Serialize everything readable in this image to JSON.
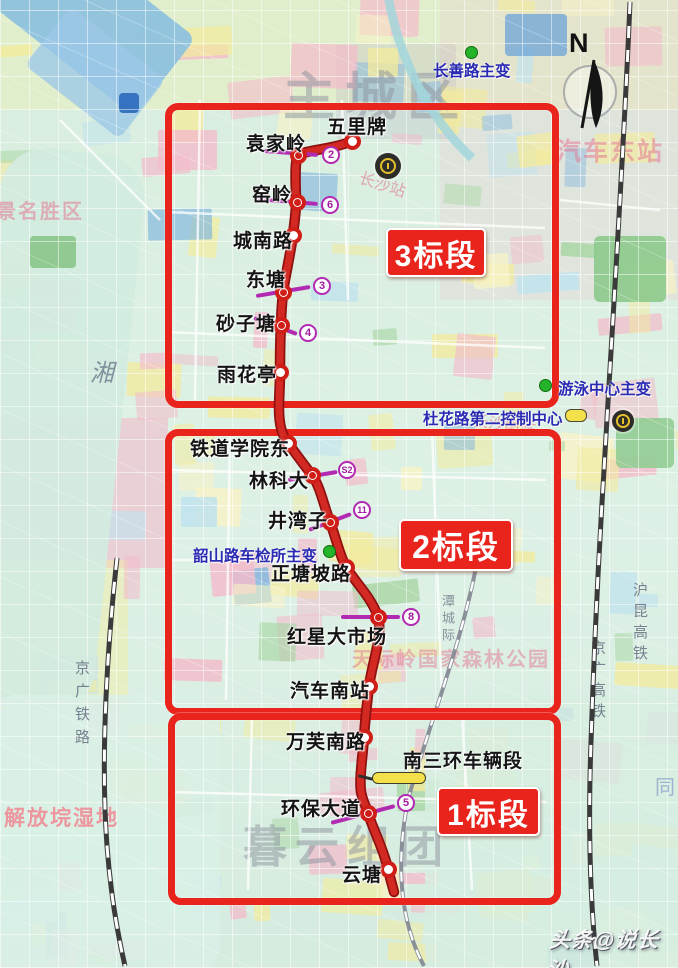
{
  "colors": {
    "metro_line": "#d22a22",
    "metro_line_edge": "#8f1010",
    "section_red": "#e8241c",
    "badge_purple": "#b12ab1",
    "facility_blue": "#2a2ab2",
    "green_dot": "#25b32a",
    "depot_yellow": "#f3e04b"
  },
  "compass": {
    "label": "N"
  },
  "credit": {
    "text": "头条@说长沙"
  },
  "sections": [
    {
      "id": "3",
      "label": "3标段",
      "box": {
        "x": 165,
        "y": 103,
        "w": 380,
        "h": 291
      },
      "tag": {
        "x": 386,
        "y": 228,
        "w": 96,
        "h": 45,
        "font": 30
      }
    },
    {
      "id": "2",
      "label": "2标段",
      "box": {
        "x": 165,
        "y": 429,
        "w": 382,
        "h": 272
      },
      "tag": {
        "x": 399,
        "y": 519,
        "w": 110,
        "h": 48,
        "font": 32
      }
    },
    {
      "id": "1",
      "label": "1标段",
      "box": {
        "x": 168,
        "y": 713,
        "w": 379,
        "h": 178
      },
      "tag": {
        "x": 437,
        "y": 787,
        "w": 99,
        "h": 45,
        "font": 30
      }
    }
  ],
  "stations": [
    {
      "name": "五里牌",
      "x": 352,
      "y": 141,
      "transfer": false,
      "label": {
        "x": 327,
        "y": 112
      }
    },
    {
      "name": "袁家岭",
      "x": 298,
      "y": 155,
      "transfer": true,
      "label": {
        "x": 246,
        "y": 129
      },
      "badge": {
        "text": "2",
        "x": 331,
        "y": 155
      },
      "tick": {
        "x1": 264,
        "y1": 151,
        "x2": 318,
        "y2": 155
      }
    },
    {
      "name": "窑岭",
      "x": 297,
      "y": 202,
      "transfer": true,
      "label": {
        "x": 252,
        "y": 180
      },
      "badge": {
        "text": "6",
        "x": 330,
        "y": 205
      },
      "tick": {
        "x1": 256,
        "y1": 199,
        "x2": 318,
        "y2": 204
      }
    },
    {
      "name": "城南路",
      "x": 293,
      "y": 235,
      "transfer": false,
      "label": {
        "x": 233,
        "y": 226
      }
    },
    {
      "name": "东塘",
      "x": 283,
      "y": 292,
      "transfer": true,
      "label": {
        "x": 246,
        "y": 265
      },
      "badge": {
        "text": "3",
        "x": 322,
        "y": 286
      },
      "tick": {
        "x1": 256,
        "y1": 296,
        "x2": 310,
        "y2": 287
      }
    },
    {
      "name": "砂子塘",
      "x": 281,
      "y": 325,
      "transfer": true,
      "label": {
        "x": 216,
        "y": 309
      },
      "badge": {
        "text": "4",
        "x": 308,
        "y": 333
      },
      "tick": {
        "x1": 254,
        "y1": 318,
        "x2": 297,
        "y2": 334
      }
    },
    {
      "name": "雨花亭",
      "x": 280,
      "y": 372,
      "transfer": false,
      "label": {
        "x": 217,
        "y": 360
      }
    },
    {
      "name": "铁道学院东",
      "x": 288,
      "y": 443,
      "transfer": false,
      "label": {
        "x": 190,
        "y": 434
      }
    },
    {
      "name": "林科大",
      "x": 312,
      "y": 475,
      "transfer": true,
      "label": {
        "x": 249,
        "y": 466
      },
      "badge": {
        "text": "S2",
        "x": 347,
        "y": 470
      },
      "tick": {
        "x1": 288,
        "y1": 480,
        "x2": 337,
        "y2": 472
      }
    },
    {
      "name": "井湾子",
      "x": 330,
      "y": 522,
      "transfer": true,
      "label": {
        "x": 268,
        "y": 506
      },
      "badge": {
        "text": "11",
        "x": 362,
        "y": 510
      },
      "tick": {
        "x1": 309,
        "y1": 530,
        "x2": 351,
        "y2": 514
      }
    },
    {
      "name": "正塘坡路",
      "x": 346,
      "y": 567,
      "transfer": false,
      "label": {
        "x": 271,
        "y": 559
      }
    },
    {
      "name": "红星大市场",
      "x": 378,
      "y": 617,
      "transfer": true,
      "label": {
        "x": 287,
        "y": 622
      },
      "badge": {
        "text": "8",
        "x": 411,
        "y": 617
      },
      "tick": {
        "x1": 341,
        "y1": 617,
        "x2": 400,
        "y2": 617
      }
    },
    {
      "name": "汽车南站",
      "x": 369,
      "y": 686,
      "transfer": false,
      "label": {
        "x": 290,
        "y": 676
      }
    },
    {
      "name": "万芙南路",
      "x": 364,
      "y": 737,
      "transfer": false,
      "label": {
        "x": 286,
        "y": 727
      }
    },
    {
      "name": "环保大道",
      "x": 368,
      "y": 813,
      "transfer": true,
      "label": {
        "x": 281,
        "y": 794
      },
      "badge": {
        "text": "5",
        "x": 406,
        "y": 803
      },
      "tick": {
        "x1": 331,
        "y1": 823,
        "x2": 395,
        "y2": 806
      }
    },
    {
      "name": "云塘",
      "x": 388,
      "y": 869,
      "transfer": false,
      "label": {
        "x": 342,
        "y": 860
      }
    }
  ],
  "facilities": [
    {
      "type": "substation",
      "label": "长善路主变",
      "dot": {
        "x": 471,
        "y": 52
      },
      "label_pos": {
        "x": 433,
        "y": 59
      }
    },
    {
      "type": "substation",
      "label": "游泳中心主变",
      "dot": {
        "x": 545,
        "y": 385
      },
      "label_pos": {
        "x": 558,
        "y": 377
      }
    },
    {
      "type": "control_center",
      "label": "杜花路第二控制中心",
      "symbol": {
        "x": 565,
        "y": 409
      },
      "label_pos": {
        "x": 423,
        "y": 407
      }
    },
    {
      "type": "substation",
      "label": "韶山路车检所主变",
      "dot": {
        "x": 329,
        "y": 551
      },
      "label_pos": {
        "x": 193,
        "y": 544
      }
    },
    {
      "type": "depot",
      "label": "南三环车辆段",
      "symbol": {
        "x": 372,
        "y": 772
      },
      "label_pos": {
        "x": 403,
        "y": 746
      }
    }
  ],
  "rail_icons": [
    {
      "x": 388,
      "y": 166,
      "size": 26
    },
    {
      "x": 623,
      "y": 421,
      "size": 22
    }
  ],
  "bg_labels": [
    {
      "text": "主城区",
      "x": 283,
      "y": 72,
      "size": 52,
      "color": "rgba(140,146,158,0.5)",
      "bold": true,
      "spacing": 10
    },
    {
      "text": "暮云组团",
      "x": 243,
      "y": 826,
      "size": 44,
      "color": "rgba(140,146,158,0.5)",
      "bold": true,
      "spacing": 8
    },
    {
      "text": "汽车东站",
      "x": 556,
      "y": 140,
      "size": 25,
      "color": "rgba(228,120,150,0.55)",
      "bold": true,
      "spacing": 2
    },
    {
      "text": "长沙站",
      "x": 358,
      "y": 178,
      "size": 16,
      "color": "rgba(225,115,145,0.6)",
      "rotate": 18
    },
    {
      "text": "长沙南站",
      "x": 472,
      "y": 418,
      "size": 16,
      "color": "rgba(225,115,145,0.6)",
      "rotate": 8
    },
    {
      "text": "天际岭国家森林公园",
      "x": 352,
      "y": 650,
      "size": 20,
      "color": "rgba(228,120,150,0.5)",
      "bold": true,
      "spacing": 2
    },
    {
      "text": "风景名胜区",
      "x": -26,
      "y": 202,
      "size": 20,
      "color": "rgba(228,120,150,0.55)",
      "bold": true,
      "spacing": 2
    },
    {
      "text": "解放垸湿地",
      "x": 4,
      "y": 808,
      "size": 21,
      "color": "rgba(240,128,140,0.8)",
      "bold": true,
      "spacing": 2
    },
    {
      "text": "湘",
      "x": 90,
      "y": 362,
      "size": 24,
      "color": "rgba(110,120,140,0.8)",
      "italic": true
    },
    {
      "text": "同",
      "x": 655,
      "y": 778,
      "size": 20,
      "color": "rgba(120,140,200,0.6)"
    },
    {
      "text": "京广铁路",
      "x": 74,
      "y": 660,
      "size": 15,
      "color": "rgba(100,110,128,0.85)",
      "vertical": true,
      "spacing": 8
    },
    {
      "text": "沪昆高铁",
      "x": 632,
      "y": 582,
      "size": 15,
      "color": "rgba(100,110,128,0.85)",
      "vertical": true,
      "spacing": 6
    },
    {
      "text": "京广高铁",
      "x": 590,
      "y": 640,
      "size": 15,
      "color": "rgba(100,110,128,0.85)",
      "vertical": true,
      "spacing": 6
    },
    {
      "text": "潭城际",
      "x": 441,
      "y": 594,
      "size": 13,
      "color": "rgba(110,120,135,0.8)",
      "vertical": true,
      "spacing": 4
    }
  ]
}
